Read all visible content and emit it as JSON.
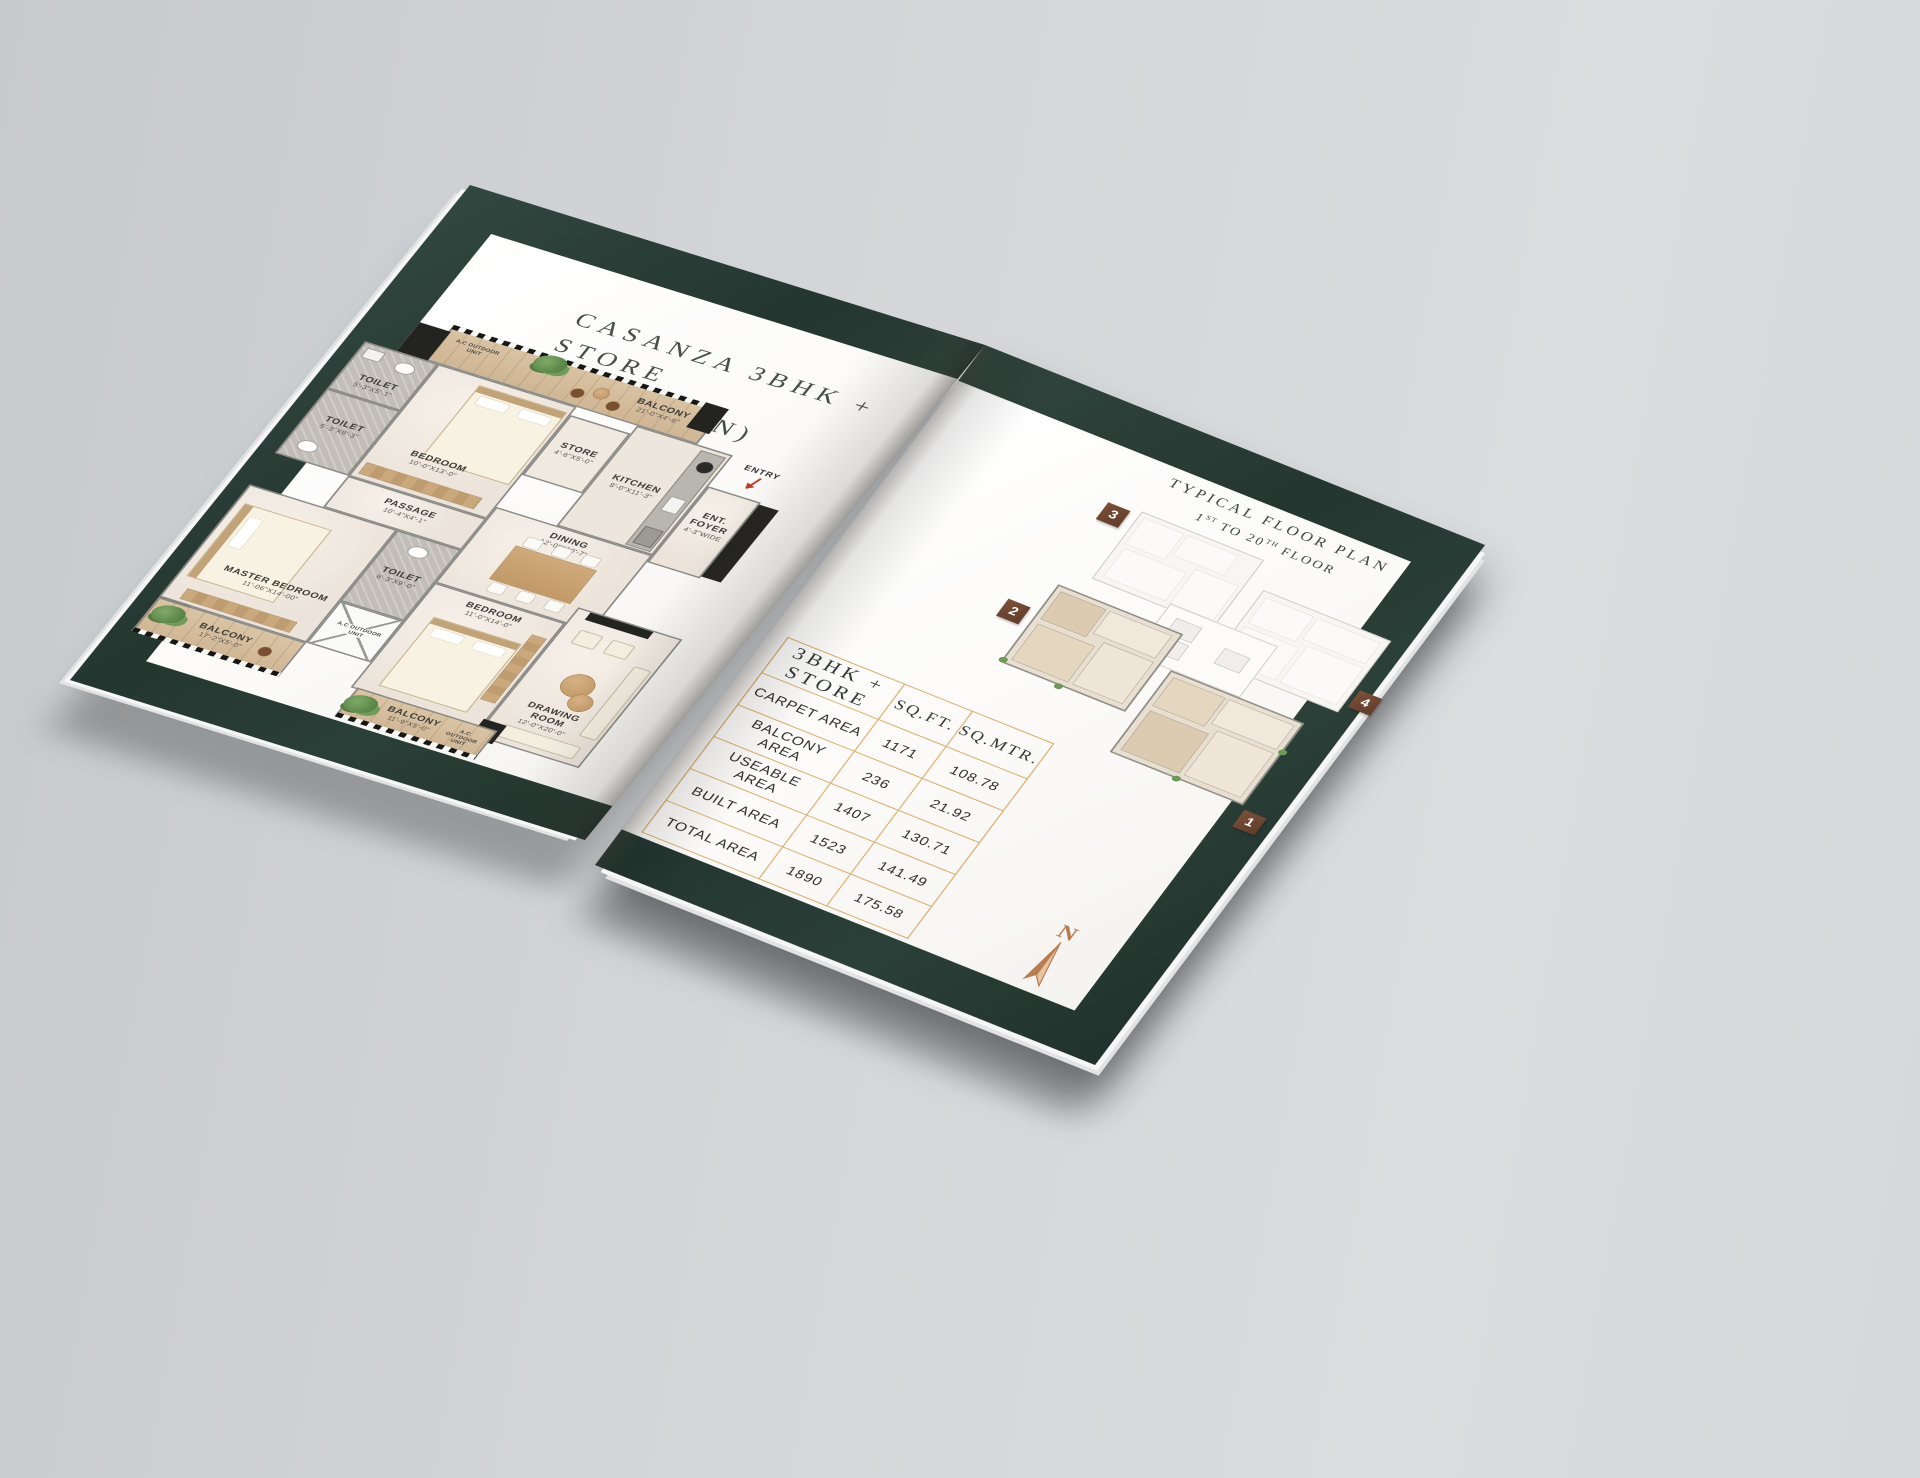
{
  "left_page": {
    "title_line1": "CASANZA 3BHK + STORE",
    "title_line2": "(UNIT PLAN)"
  },
  "floorplan": {
    "ac_label": "A.C OUTDOOR UNIT",
    "entry_label": "ENTRY",
    "rooms": [
      {
        "name": "BALCONY",
        "dims": "21'-0\"X4'-6\""
      },
      {
        "name": "TOILET",
        "dims": "5'-3\"X5'-1\""
      },
      {
        "name": "TOILET",
        "dims": "5'-3\"X9'-3\""
      },
      {
        "name": "BEDROOM",
        "dims": "10'-0\"X13'-0\""
      },
      {
        "name": "STORE",
        "dims": "4'-6\"X5'-0\""
      },
      {
        "name": "KITCHEN",
        "dims": "8'-0\"X11'-3\""
      },
      {
        "name": "ENT. FOYER",
        "dims": "4'-3\"WIDE"
      },
      {
        "name": "PASSAGE",
        "dims": "10'-4\"X4'-1\""
      },
      {
        "name": "DINING",
        "dims": "12'-0\"X10'-7\""
      },
      {
        "name": "MASTER BEDROOM",
        "dims": "11'-06\"X14'-00\""
      },
      {
        "name": "TOILET",
        "dims": "6'-3\"X9'-0\""
      },
      {
        "name": "BEDROOM",
        "dims": "11'-0\"X14'-0\""
      },
      {
        "name": "DRAWING ROOM",
        "dims": "12'-0\"X20'-0\""
      },
      {
        "name": "BALCONY",
        "dims": "17'-2\"X5'-0\""
      },
      {
        "name": "BALCONY",
        "dims": "11'-9\"X5'-0\""
      }
    ]
  },
  "right_page": {
    "plan_title_line1": "TYPICAL FLOOR PLAN",
    "floor_range": {
      "n1": "1",
      "s1": "ST",
      "mid": " TO 20",
      "s2": "TH",
      "tail": " FLOOR"
    },
    "badges": [
      "1",
      "2",
      "3",
      "4"
    ],
    "compass_label": "N"
  },
  "area_table": {
    "header": "3BHK + STORE",
    "col_sqft": "SQ.FT.",
    "col_sqmtr": "SQ.MTR.",
    "rows": [
      {
        "label": "CARPET AREA",
        "sqft": "1171",
        "sqmtr": "108.78"
      },
      {
        "label": "BALCONY AREA",
        "sqft": "236",
        "sqmtr": "21.92"
      },
      {
        "label": "USEABLE AREA",
        "sqft": "1407",
        "sqmtr": "130.71"
      },
      {
        "label": "BUILT AREA",
        "sqft": "1523",
        "sqmtr": "141.49"
      },
      {
        "label": "TOTAL AREA",
        "sqft": "1890",
        "sqmtr": "175.58"
      }
    ]
  }
}
